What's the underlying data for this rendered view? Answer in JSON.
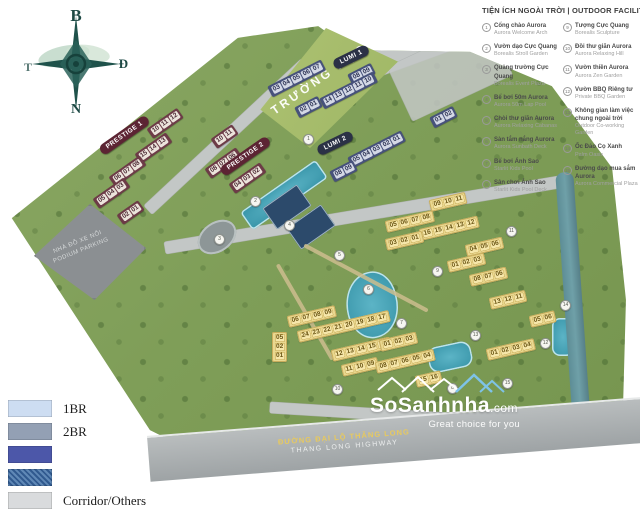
{
  "compass": {
    "north": "B",
    "east": "Đ",
    "south": "N",
    "west": "T"
  },
  "facilities": {
    "title": "TIỆN ÍCH NGOÀI TRỜI | OUTDOOR FACILITIES",
    "columns": [
      {
        "items": [
          {
            "num": "1",
            "vn": "Cổng chào Aurora",
            "en": "Aurora Welcome Arch"
          },
          {
            "num": "2",
            "vn": "Vườn dạo Cực Quang",
            "en": "Borealis Stroll Garden"
          },
          {
            "num": "3",
            "vn": "Quảng trường Cực Quang",
            "en": "Borealis Event Plaza"
          },
          {
            "num": "4",
            "vn": "Bể bơi 50m Aurora",
            "en": "Aurora 50m Lap Pool"
          },
          {
            "num": "5",
            "vn": "Chòi thư giãn Aurora",
            "en": "Aurora Relaxing Cabanas"
          },
          {
            "num": "6",
            "vn": "Sàn tắm nắng Aurora",
            "en": "Aurora Sunbath Deck"
          },
          {
            "num": "7",
            "vn": "Bể bơi Ánh Sao",
            "en": "Starlit Kids Pool"
          },
          {
            "num": "8",
            "vn": "Sân chơi Ánh Sao",
            "en": "Starlit Kids Pool Deck"
          }
        ]
      },
      {
        "items": [
          {
            "num": "9",
            "vn": "Tượng Cực Quang",
            "en": "Borealis Sculpture"
          },
          {
            "num": "10",
            "vn": "Đồi thư giãn Aurora",
            "en": "Aurora Relaxing Hill"
          },
          {
            "num": "11",
            "vn": "Vườn thiền Aurora",
            "en": "Aurora Zen Garden"
          },
          {
            "num": "12",
            "vn": "Vườn BBQ Riêng tư",
            "en": "Private BBQ Garden"
          },
          {
            "num": "13",
            "vn": "Không gian làm việc chung ngoài trời",
            "en": "Outdoor Co-working Garden"
          },
          {
            "num": "14",
            "vn": "Ốc Đảo Cọ Xanh",
            "en": "Palm Oasis"
          },
          {
            "num": "15",
            "vn": "Đường dạo mua sắm Aurora",
            "en": "Aurora Commercial Plaza"
          }
        ]
      }
    ]
  },
  "legend": {
    "items": [
      {
        "label": "1BR",
        "color": "#cdddf2",
        "textured": false
      },
      {
        "label": "2BR",
        "color": "#93a0b4",
        "textured": false
      },
      {
        "label": "",
        "color": "#4c57a9",
        "textured": false
      },
      {
        "label": "",
        "color": "#3c6ea6",
        "textured": true
      },
      {
        "label": "Corridor/Others",
        "color": "#d9dbdd",
        "textured": false
      }
    ]
  },
  "map": {
    "labels": {
      "school": "TRƯỜNG HỌC",
      "parking_vn": "NHÀ ĐỖ XE NỔI",
      "parking_en": "PODIUM PARKING",
      "highway_vn": "ĐƯỜNG ĐẠI LỘ THĂNG LONG",
      "highway_en": "THANG LONG HIGHWAY",
      "park": "CÔNG VIÊN"
    },
    "zone_labels": [
      {
        "text": "PRESTIGE 1",
        "scheme": "maroon",
        "x": 101,
        "y": 146,
        "rot": -35
      },
      {
        "text": "PRESTIGE 2",
        "scheme": "maroon",
        "x": 222,
        "y": 167,
        "rot": -35
      },
      {
        "text": "LUMI 1",
        "scheme": "navy",
        "x": 334,
        "y": 60,
        "rot": -26
      },
      {
        "text": "LUMI 2",
        "scheme": "navy",
        "x": 318,
        "y": 146,
        "rot": -26
      }
    ],
    "clusters": [
      {
        "scheme": "maroon",
        "x": 150,
        "y": 128,
        "rot": -35,
        "tags": [
          "10",
          "11",
          "12"
        ]
      },
      {
        "scheme": "maroon",
        "x": 138,
        "y": 153,
        "rot": -35,
        "tags": [
          "15",
          "14",
          "13"
        ]
      },
      {
        "scheme": "maroon",
        "x": 112,
        "y": 176,
        "rot": -35,
        "tags": [
          "06",
          "07",
          "08"
        ]
      },
      {
        "scheme": "maroon",
        "x": 96,
        "y": 198,
        "rot": -35,
        "tags": [
          "05",
          "04",
          "03"
        ]
      },
      {
        "scheme": "maroon",
        "x": 120,
        "y": 214,
        "rot": -35,
        "tags": [
          "02",
          "01"
        ]
      },
      {
        "scheme": "maroon",
        "x": 214,
        "y": 138,
        "rot": -35,
        "tags": [
          "10",
          "11"
        ]
      },
      {
        "scheme": "maroon",
        "x": 208,
        "y": 168,
        "rot": -35,
        "tags": [
          "08",
          "07",
          "06"
        ]
      },
      {
        "scheme": "maroon",
        "x": 232,
        "y": 183,
        "rot": -35,
        "tags": [
          "04",
          "03",
          "02"
        ]
      },
      {
        "scheme": "navy",
        "x": 270,
        "y": 86,
        "rot": -27,
        "tags": [
          "03",
          "04",
          "05",
          "06",
          "07"
        ]
      },
      {
        "scheme": "navy",
        "x": 350,
        "y": 74,
        "rot": -27,
        "tags": [
          "08",
          "09"
        ]
      },
      {
        "scheme": "navy",
        "x": 322,
        "y": 98,
        "rot": -27,
        "tags": [
          "14",
          "13",
          "12",
          "11",
          "10"
        ]
      },
      {
        "scheme": "navy",
        "x": 297,
        "y": 107,
        "rot": -27,
        "tags": [
          "02",
          "01"
        ]
      },
      {
        "scheme": "navy",
        "x": 350,
        "y": 157,
        "rot": -27,
        "tags": [
          "05",
          "04",
          "03",
          "02",
          "01"
        ]
      },
      {
        "scheme": "navy",
        "x": 332,
        "y": 171,
        "rot": -27,
        "tags": [
          "08",
          "09"
        ]
      },
      {
        "scheme": "navy",
        "x": 432,
        "y": 117,
        "rot": -27,
        "tags": [
          "01",
          "02"
        ]
      },
      {
        "scheme": "yellow",
        "x": 430,
        "y": 200,
        "rot": -13,
        "tags": [
          "09",
          "10",
          "11"
        ]
      },
      {
        "scheme": "yellow",
        "x": 386,
        "y": 221,
        "rot": -13,
        "tags": [
          "05",
          "06",
          "07",
          "08"
        ]
      },
      {
        "scheme": "yellow",
        "x": 420,
        "y": 229,
        "rot": -13,
        "tags": [
          "16",
          "15",
          "14",
          "13",
          "12"
        ]
      },
      {
        "scheme": "yellow",
        "x": 386,
        "y": 239,
        "rot": -13,
        "tags": [
          "03",
          "02",
          "01"
        ]
      },
      {
        "scheme": "yellow",
        "x": 466,
        "y": 245,
        "rot": -13,
        "tags": [
          "04",
          "05",
          "06"
        ]
      },
      {
        "scheme": "yellow",
        "x": 448,
        "y": 261,
        "rot": -13,
        "tags": [
          "01",
          "02",
          "03"
        ]
      },
      {
        "scheme": "yellow",
        "x": 470,
        "y": 275,
        "rot": -13,
        "tags": [
          "08",
          "07",
          "06"
        ]
      },
      {
        "scheme": "yellow",
        "x": 490,
        "y": 298,
        "rot": -13,
        "tags": [
          "13",
          "12",
          "11"
        ]
      },
      {
        "scheme": "yellow",
        "x": 530,
        "y": 316,
        "rot": -13,
        "tags": [
          "05",
          "06"
        ]
      },
      {
        "scheme": "yellow",
        "x": 487,
        "y": 349,
        "rot": -13,
        "tags": [
          "01",
          "02",
          "03",
          "04"
        ]
      },
      {
        "scheme": "yellow",
        "x": 272,
        "y": 332,
        "rot": 0,
        "dir": "col",
        "tags": [
          "05",
          "02",
          "01"
        ]
      },
      {
        "scheme": "yellow",
        "x": 288,
        "y": 316,
        "rot": -13,
        "tags": [
          "06",
          "07",
          "08",
          "09"
        ]
      },
      {
        "scheme": "yellow",
        "x": 298,
        "y": 331,
        "rot": -13,
        "tags": [
          "24",
          "23",
          "22",
          "21",
          "20",
          "19",
          "18",
          "17"
        ]
      },
      {
        "scheme": "yellow",
        "x": 332,
        "y": 350,
        "rot": -13,
        "tags": [
          "12",
          "13",
          "14",
          "15",
          "16"
        ]
      },
      {
        "scheme": "yellow",
        "x": 342,
        "y": 365,
        "rot": -13,
        "tags": [
          "11",
          "10",
          "09"
        ]
      },
      {
        "scheme": "yellow",
        "x": 380,
        "y": 340,
        "rot": -13,
        "tags": [
          "01",
          "02",
          "03"
        ]
      },
      {
        "scheme": "yellow",
        "x": 376,
        "y": 362,
        "rot": -13,
        "tags": [
          "08",
          "07",
          "06",
          "05",
          "04"
        ]
      },
      {
        "scheme": "yellow",
        "x": 416,
        "y": 376,
        "rot": -13,
        "tags": [
          "15",
          "16"
        ]
      }
    ],
    "markers": [
      {
        "n": "1",
        "x": 303,
        "y": 134
      },
      {
        "n": "2",
        "x": 250,
        "y": 196
      },
      {
        "n": "3",
        "x": 214,
        "y": 234
      },
      {
        "n": "4",
        "x": 284,
        "y": 220
      },
      {
        "n": "5",
        "x": 334,
        "y": 250
      },
      {
        "n": "6",
        "x": 363,
        "y": 284
      },
      {
        "n": "7",
        "x": 396,
        "y": 318
      },
      {
        "n": "8",
        "x": 447,
        "y": 383
      },
      {
        "n": "9",
        "x": 432,
        "y": 266
      },
      {
        "n": "10",
        "x": 332,
        "y": 384
      },
      {
        "n": "11",
        "x": 506,
        "y": 226
      },
      {
        "n": "12",
        "x": 540,
        "y": 338
      },
      {
        "n": "13",
        "x": 470,
        "y": 330
      },
      {
        "n": "14",
        "x": 560,
        "y": 300
      },
      {
        "n": "15",
        "x": 502,
        "y": 378
      }
    ],
    "colors": {
      "maroon": "#6d3b47",
      "maroon_tag": "#ece4dc",
      "navy": "#47527b",
      "navy_tag": "#d4d9e6",
      "yellow": "#ead890",
      "yellow_tag": "#f6e7ab",
      "pill_maroon": "#5c2433",
      "pill_navy": "#2b3146"
    }
  },
  "watermark": {
    "brand": "SoSanhnha",
    "tld": ".com",
    "tagline": "Great choice for you"
  }
}
